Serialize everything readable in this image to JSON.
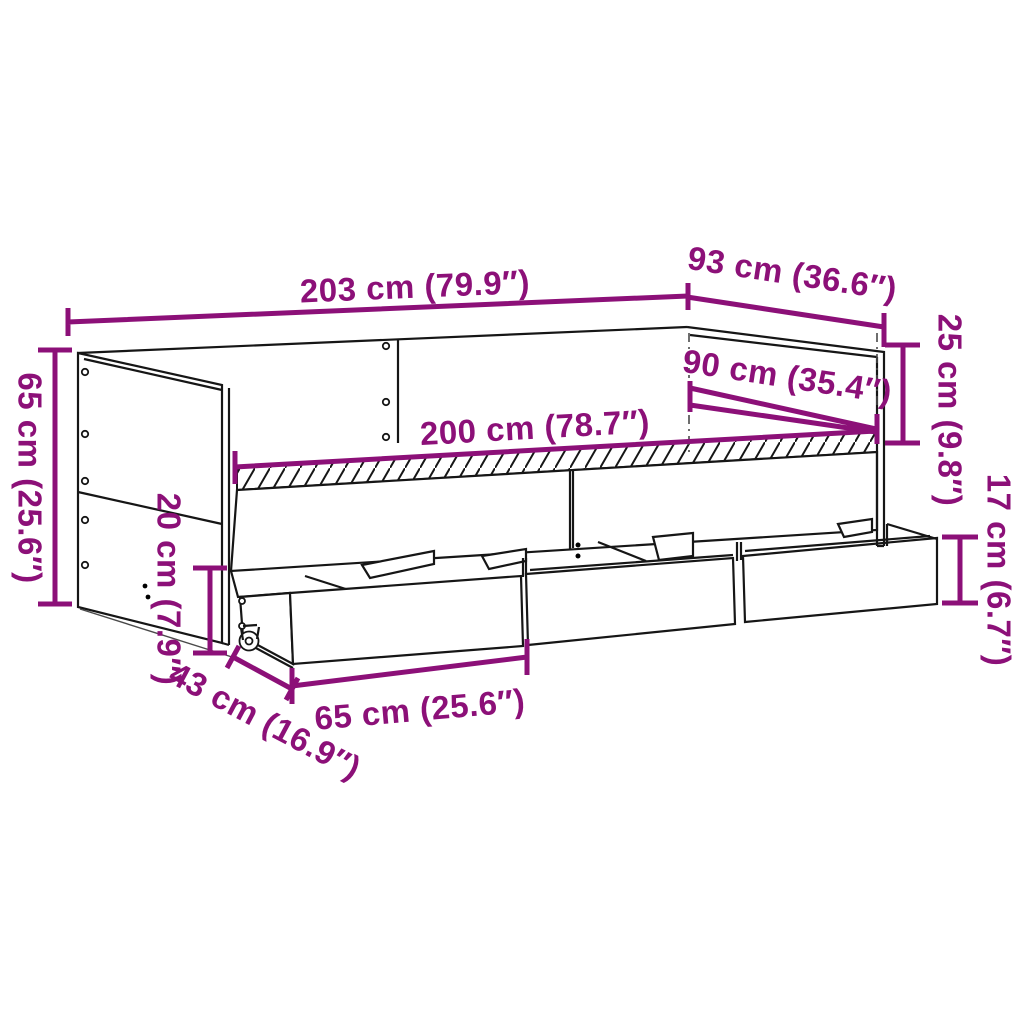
{
  "diagram": {
    "subject": "Daybed with under-bed storage drawers - dimension drawing",
    "background": "#ffffff",
    "colors": {
      "dimension": "#8c1078",
      "outline": "#161616",
      "extension": "#4a4a4a"
    },
    "dimensions": {
      "overall_length": {
        "label": "203 cm (79.9″)",
        "cm": 203,
        "inches": 79.9
      },
      "overall_depth": {
        "label": "93 cm (36.6″)",
        "cm": 93,
        "inches": 36.6
      },
      "backrest_above_base": {
        "label": "25 cm (9.8″)",
        "cm": 25,
        "inches": 9.8
      },
      "sleeping_width": {
        "label": "90 cm (35.4″)",
        "cm": 90,
        "inches": 35.4
      },
      "sleeping_length": {
        "label": "200 cm (78.7″)",
        "cm": 200,
        "inches": 78.7
      },
      "side_height": {
        "label": "65 cm (25.6″)",
        "cm": 65,
        "inches": 25.6
      },
      "base_clearance": {
        "label": "20 cm (7.9″)",
        "cm": 20,
        "inches": 7.9
      },
      "drawer_height": {
        "label": "17 cm (6.7″)",
        "cm": 17,
        "inches": 6.7
      },
      "drawer_depth": {
        "label": "43 cm (16.9″)",
        "cm": 43,
        "inches": 16.9
      },
      "drawer_width": {
        "label": "65 cm (25.6″)",
        "cm": 65,
        "inches": 25.6
      }
    }
  }
}
